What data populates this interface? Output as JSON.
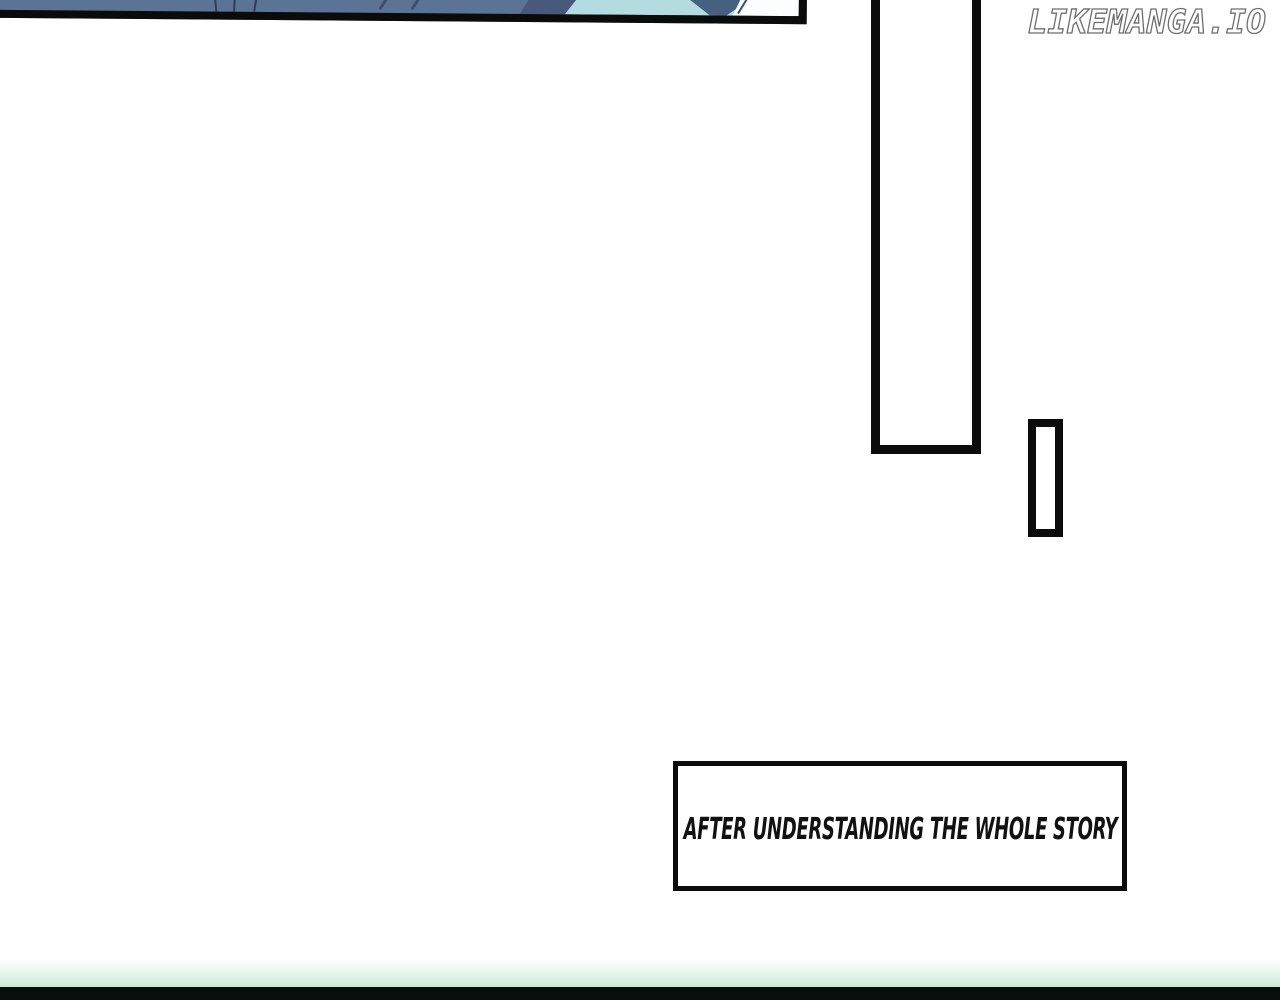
{
  "watermark": {
    "text": "LIKEMANGA.IO"
  },
  "caption_box": {
    "text": "AFTER UNDERSTANDING THE WHOLE STORY"
  },
  "colors": {
    "panel_border": "#0b0b0b",
    "art_base": "#5b7394",
    "art_dark_line": "#2e3e55",
    "art_dark_band": "#49597b",
    "art_teal": "#b2dcdf",
    "art_white": "#fcfdfd",
    "footer_green": "#c9ecd6",
    "footer_bar": "#0a0e0b"
  }
}
